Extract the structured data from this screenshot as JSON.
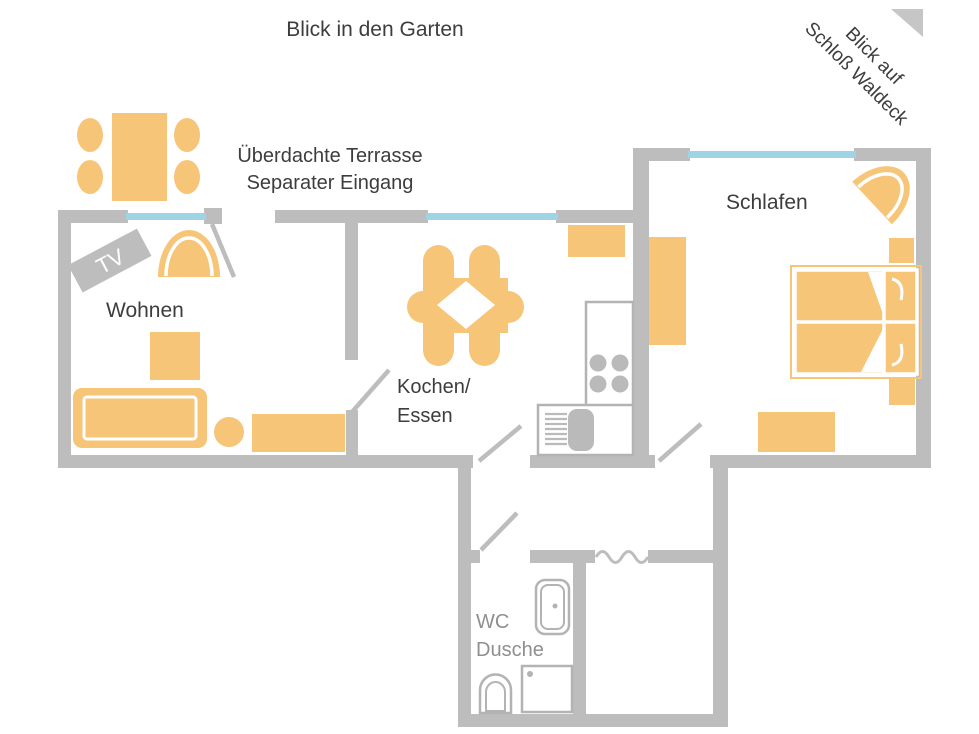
{
  "labels": {
    "garden_view": "Blick in den Garten",
    "terrace_line1": "Überdachte Terrasse",
    "terrace_line2": "Separater Eingang",
    "castle_view_line1": "Blick auf",
    "castle_view_line2": "Schloß Waldeck",
    "tv": "TV"
  },
  "rooms": {
    "living": "Wohnen",
    "kitchen_line1": "Kochen/",
    "kitchen_line2": "Essen",
    "bedroom": "Schlafen",
    "bath_line1": "WC",
    "bath_line2": "Dusche"
  },
  "colors": {
    "wall": "#bdbdbd",
    "furniture": "#f7c578",
    "window": "#9fd3e6",
    "fixture": "#b3b3b3",
    "burner": "#bababa",
    "text": "#3d3d3d",
    "bath_text": "#8f8f8f",
    "tv_text": "#ffffff",
    "triangle": "#c6c6c6",
    "bg": "#ffffff"
  }
}
